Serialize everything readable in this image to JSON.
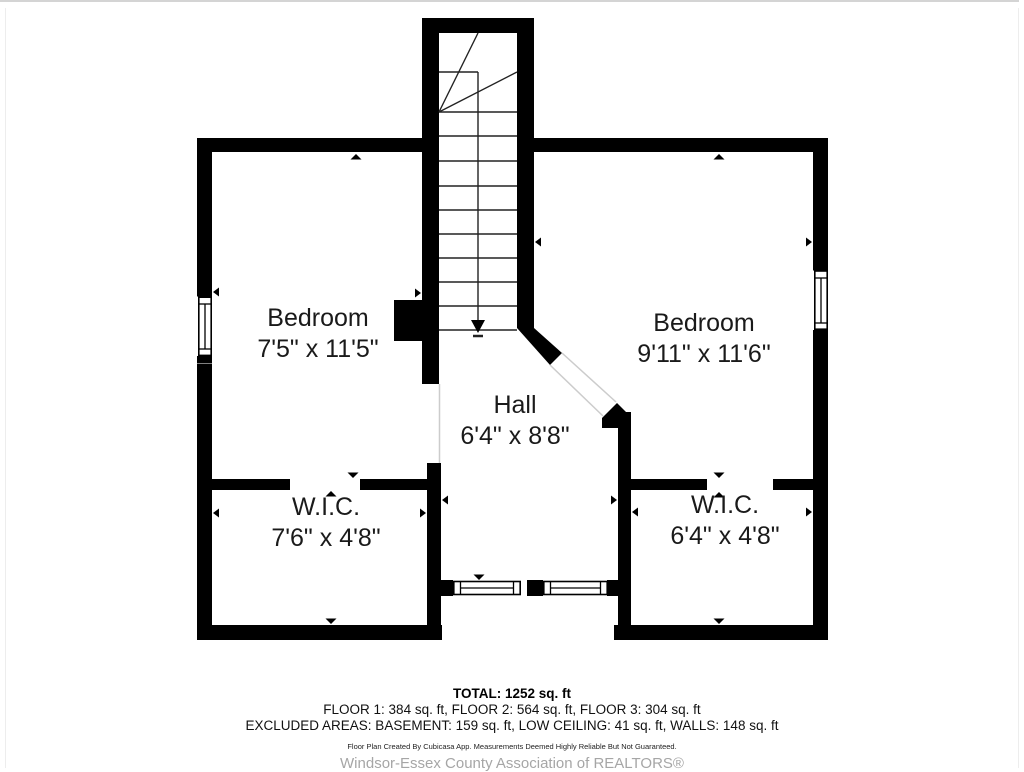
{
  "floor_plan": {
    "rooms": [
      {
        "name": "Bedroom",
        "dimensions": "7'5\" x 11'5\""
      },
      {
        "name": "Bedroom",
        "dimensions": "9'11\" x 11'6\""
      },
      {
        "name": "Hall",
        "dimensions": "6'4\" x 8'8\""
      },
      {
        "name": "W.I.C.",
        "dimensions": "7'6\" x 4'8\""
      },
      {
        "name": "W.I.C.",
        "dimensions": "6'4\" x 4'8\""
      }
    ],
    "summary": {
      "total": "TOTAL: 1252 sq. ft",
      "floors": "FLOOR 1: 384 sq. ft, FLOOR 2: 564 sq. ft, FLOOR 3: 304 sq. ft",
      "excluded": "EXCLUDED AREAS: BASEMENT: 159 sq. ft, LOW CEILING: 41 sq. ft, WALLS: 148 sq. ft"
    },
    "disclaimer": "Floor Plan Created By Cubicasa App. Measurements Deemed Highly Reliable But Not Guaranteed.",
    "attribution": "Windsor-Essex County Association of REALTORS®",
    "colors": {
      "wall": "#000000",
      "stair_line": "#222222",
      "opening_line": "#cccccc",
      "attribution_gray": "#a6a6a6"
    }
  }
}
